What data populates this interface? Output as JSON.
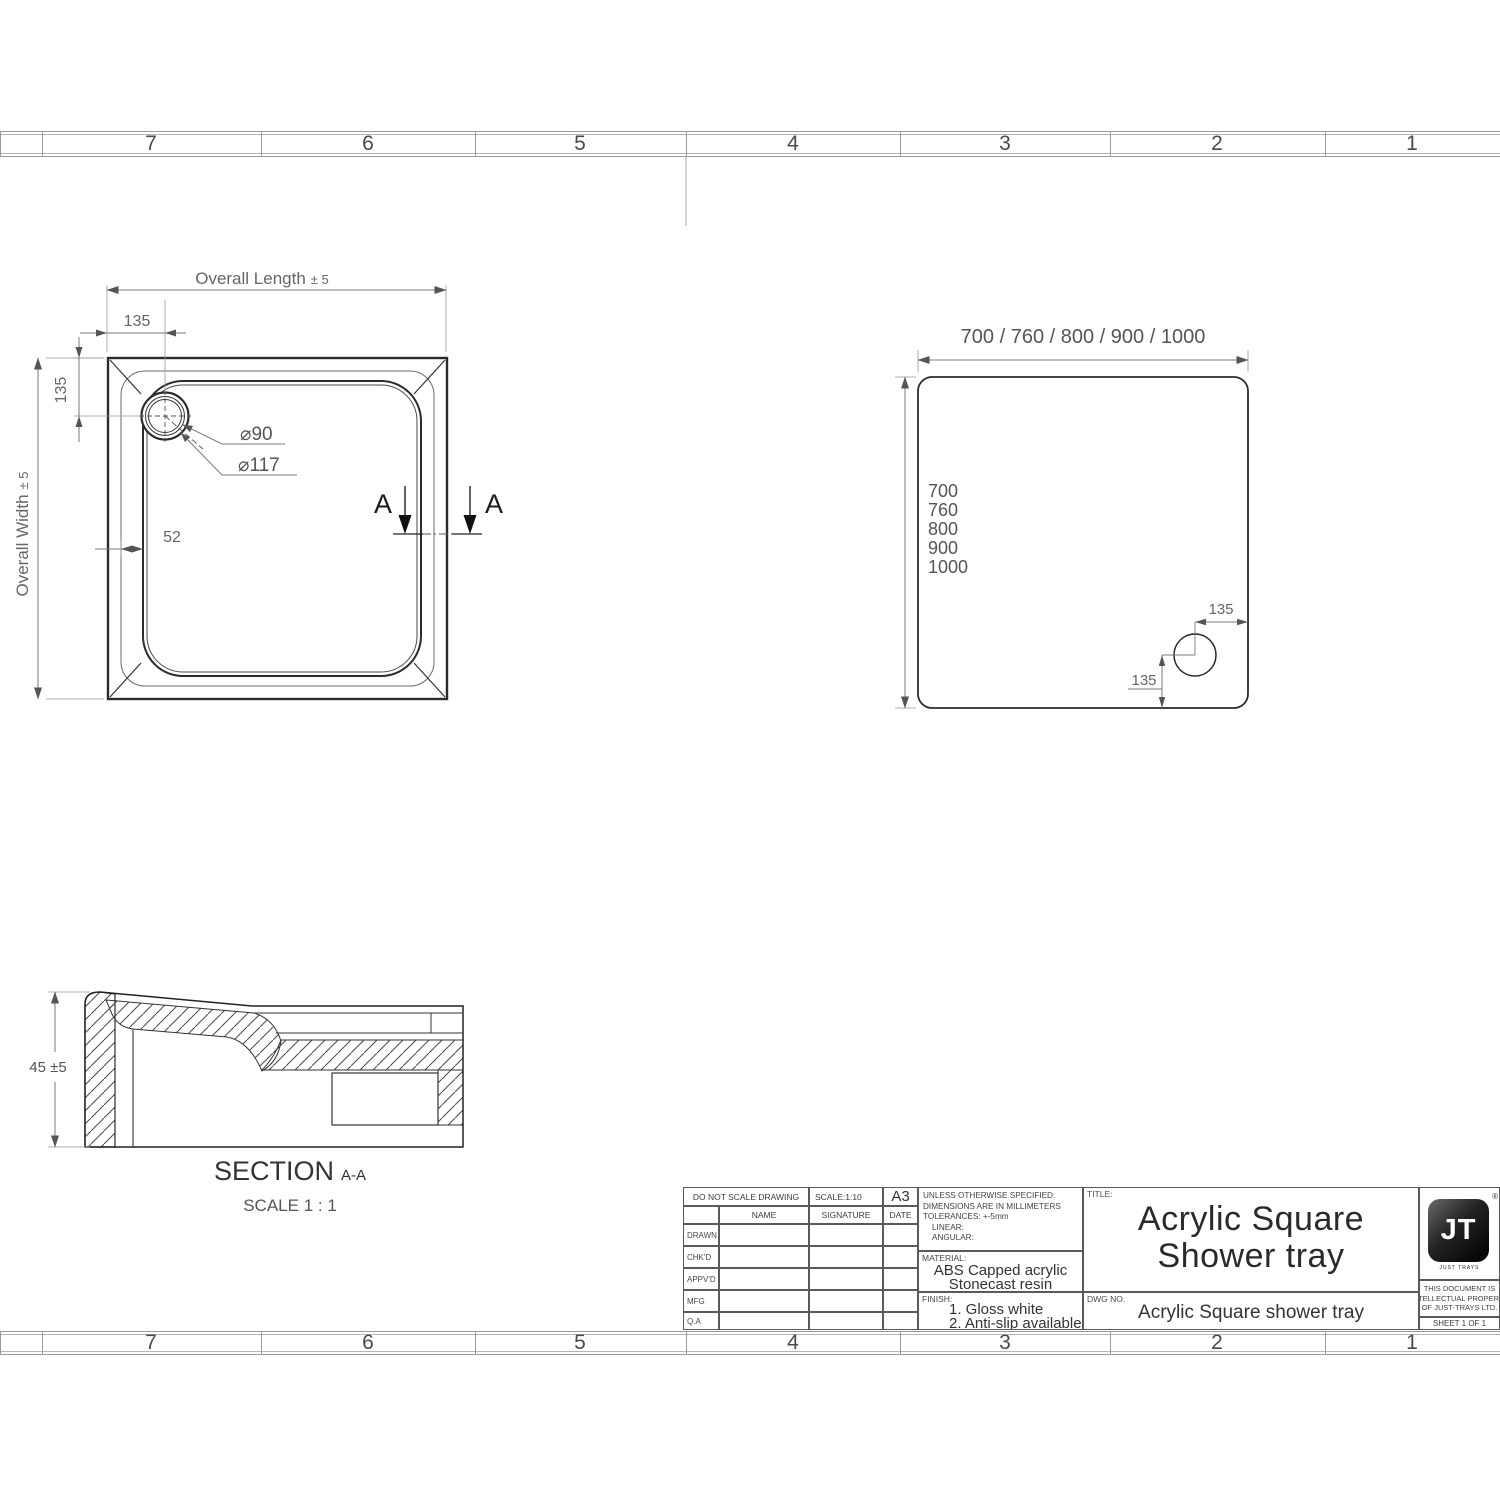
{
  "rulers": {
    "top": {
      "cells": [
        "7",
        "6",
        "5",
        "4",
        "3",
        "2",
        "1"
      ]
    },
    "bottom": {
      "cells": [
        "7",
        "6",
        "5",
        "4",
        "3",
        "2",
        "1"
      ]
    }
  },
  "plan_view": {
    "overall_length_label": "Overall Length",
    "overall_length_tol": "± 5",
    "overall_width_label": "Overall Width",
    "overall_width_tol": "± 5",
    "dim_drain_offset_x": "135",
    "dim_drain_offset_y": "135",
    "dim_rim": "52",
    "drain_dia_inner": "⌀90",
    "drain_dia_outer": "⌀117",
    "section_a_left": "A",
    "section_a_right": "A"
  },
  "size_view": {
    "width_options": "700 / 760 / 800 / 900 / 1000",
    "lengths": [
      "700",
      "760",
      "800",
      "900",
      "1000"
    ],
    "drain_from_side": "135",
    "drain_from_bottom": "135"
  },
  "section_view": {
    "height_dim": "45 ±5",
    "caption": "SECTION",
    "caption_detail": "A-A",
    "scale_note": "SCALE 1 : 1"
  },
  "title_block": {
    "do_not_scale": "DO NOT SCALE DRAWING",
    "scale": "SCALE:1:10",
    "sheet_size": "A3",
    "col_name": "NAME",
    "col_signature": "SIGNATURE",
    "col_date": "DATE",
    "rows": [
      "DRAWN",
      "CHK'D",
      "APPV'D",
      "MFG",
      "Q.A"
    ],
    "tolerance_lines": [
      "UNLESS OTHERWISE SPECIFIED:",
      "DIMENSIONS ARE IN MILLIMETERS",
      "TOLERANCES: +-5mm",
      "LINEAR:",
      "ANGULAR:"
    ],
    "material_label": "MATERIAL:",
    "material_line1": "ABS Capped acrylic",
    "material_line2": "Stonecast resin",
    "finish_label": "FINISH:",
    "finish_line1": "1. Gloss white",
    "finish_line2": "2. Anti-slip available",
    "title_label": "TITLE:",
    "title_line1": "Acrylic Square",
    "title_line2": "Shower tray",
    "dwg_label": "DWG NO.",
    "dwg_value": "Acrylic Square shower tray",
    "logo_text": "JT",
    "logo_registered": "®",
    "logo_tagline": "JUST TRAYS",
    "property_note_lines": [
      "THIS DOCUMENT IS",
      "INTELLECTUAL PROPERTY",
      "OF JUST-TRAYS LTD."
    ],
    "sheet_note": "SHEET 1 OF 1"
  }
}
